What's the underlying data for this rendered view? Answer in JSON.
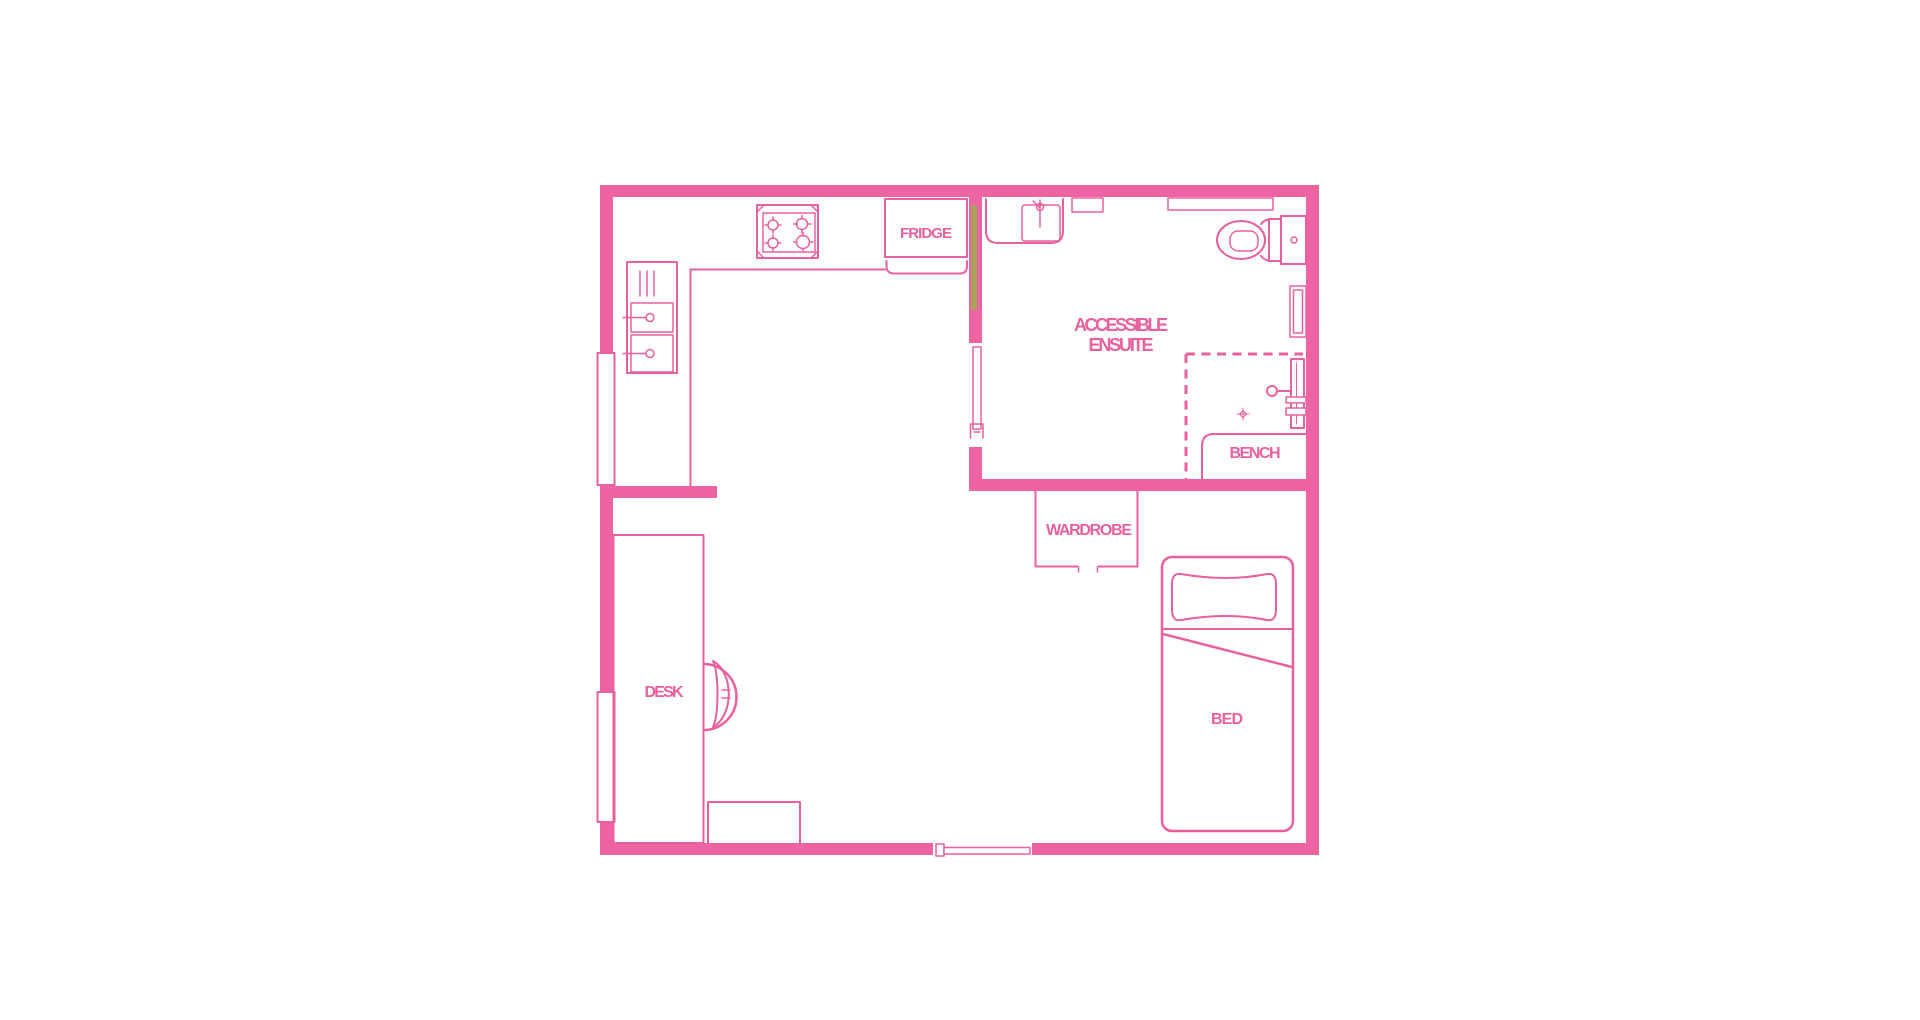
{
  "title": "Accessible studio apartment floor plan",
  "colors": {
    "pink": "#e8619e",
    "wall": "#ee64a3",
    "olive": "#a9a35c",
    "background": "#ffffff"
  },
  "labels": {
    "fridge": "FRIDGE",
    "ensuite_line1": "ACCESSIBLE",
    "ensuite_line2": "ENSUITE",
    "bench": "BENCH",
    "wardrobe": "WARDROBE",
    "desk": "DESK",
    "bed": "BED"
  },
  "icons": {
    "stove-icon": "svg: four burner circles with cross ticks",
    "kitchen-sink-icon": "svg: double basin with taps and drainer lines",
    "fridge-icon": "svg: labelled box with curved door front",
    "basin-icon": "svg: vanity box with tap",
    "toilet-icon": "svg: bowl ellipse with cistern",
    "shower-icon": "svg: wall rail, arm and head circle inside dashed zone",
    "floor-drain-icon": "svg: small diamond cross",
    "bench-icon": "svg: rounded corner slab",
    "wardrobe-icon": "svg: open-front box with handle ticks",
    "bed-icon": "svg: rounded mattress with pillow and fold line",
    "desk-icon": "svg: rectangle with chair arcs",
    "window-icon": "svg: white inset in wall",
    "door-icon": "svg: thin leaf with jamb bracket",
    "door-seal-strip-icon": "svg: olive strip on wall"
  }
}
